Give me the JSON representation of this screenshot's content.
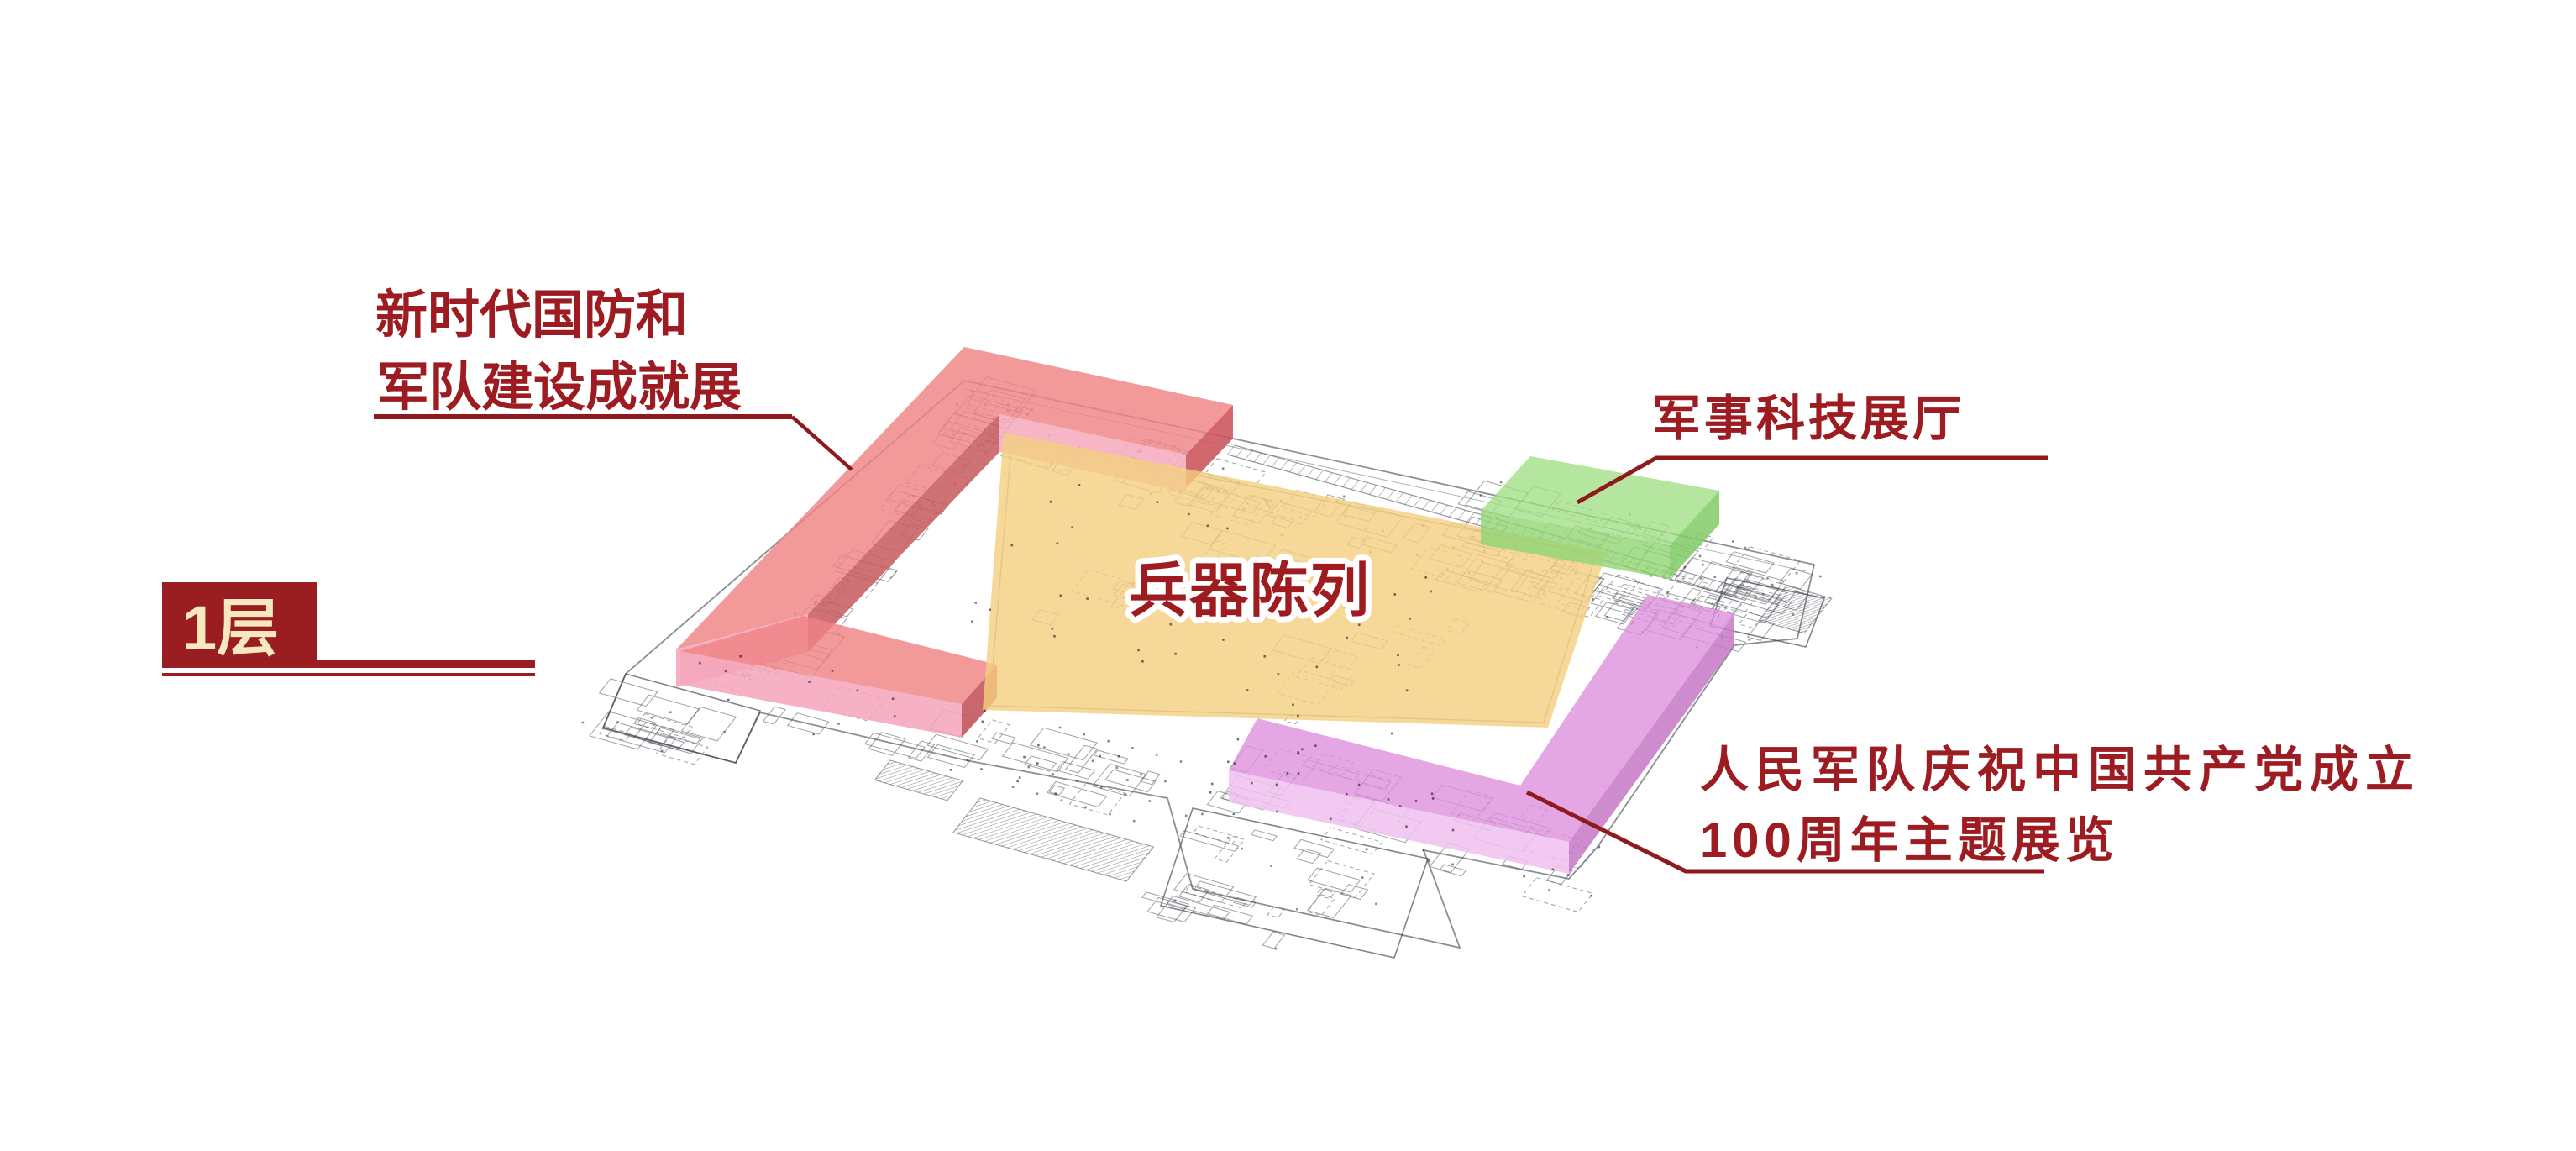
{
  "page": {
    "background": "#FFFFFF",
    "type": "museum-floor-plan-diagram"
  },
  "floor_badge": {
    "label": "1层",
    "bg_color": "#9A1D22",
    "text_color": "#F7E8C0"
  },
  "labels": {
    "defense": {
      "line1": "新时代国防和",
      "line2": "军队建设成就展",
      "color": "#9D1C21"
    },
    "weapons": {
      "text": "兵器陈列",
      "color": "#9E1B1F",
      "outline_color": "#FFFFFF"
    },
    "tech": {
      "text": "军事科技展厅",
      "color": "#9D1C21"
    },
    "centenary": {
      "line1": "人民军队庆祝中国共产党成立",
      "line2": "100周年主题展览",
      "color": "#9D1C21"
    }
  },
  "leader_color": "#8F191D",
  "zones": {
    "defense": {
      "name": "新时代国防和军队建设成就展",
      "top_color": "#EF8384",
      "inner_north_color": "#F6A9BC",
      "inner_west_color": "#C75E62",
      "end_color": "#CC585E",
      "fold_color": "#F4A4BA",
      "bar_top_color": "#EF8384",
      "bar_front_color": "#F4A4BA",
      "bar_end_color": "#C4575C"
    },
    "weapons": {
      "name": "兵器陈列",
      "fill_color": "#F4CF7F"
    },
    "tech": {
      "name": "军事科技展厅",
      "top_color": "#A0DF84",
      "left_color": "#90D573",
      "right_color": "#7FCB64"
    },
    "centenary": {
      "name": "人民军队庆祝中国共产党成立100周年主题展览",
      "top_color": "#DC8EDC",
      "side_color": "#C577C6",
      "front_color": "#F0C0EE"
    }
  },
  "plan": {
    "line_color": "#3D434B",
    "dot_color": "#15181C"
  }
}
